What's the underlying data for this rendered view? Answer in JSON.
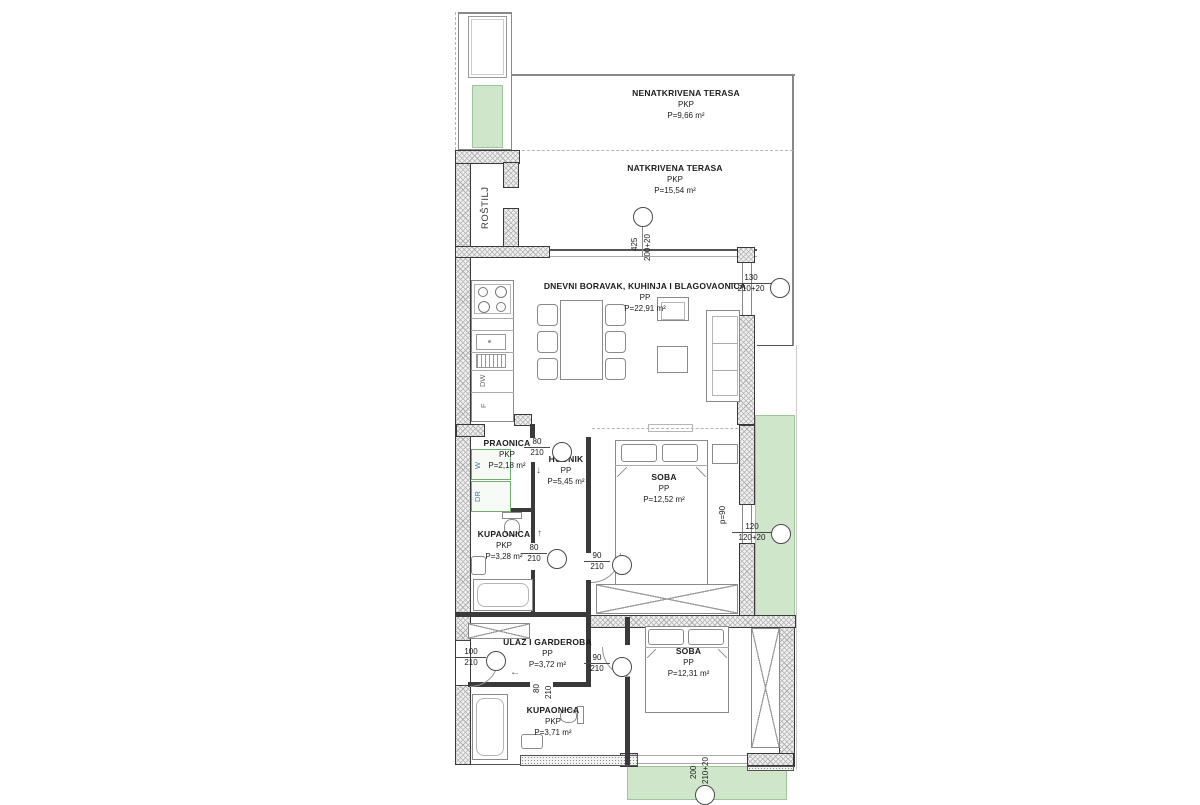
{
  "rooms": {
    "nenatkrivena_terasa": {
      "name": "NENATKRIVENA TERASA",
      "type": "PKP",
      "area": "P=9,66 m²"
    },
    "natkrivena_terasa": {
      "name": "NATKRIVENA TERASA",
      "type": "PKP",
      "area": "P=15,54 m²"
    },
    "dnevni_boravak": {
      "name": "DNEVNI BORAVAK, KUHINJA I BLAGOVAONICA",
      "type": "PP",
      "area": "P=22,91 m²"
    },
    "rostilj": {
      "name": "ROŠTILJ"
    },
    "praonica": {
      "name": "PRAONICA",
      "type": "PKP",
      "area": "P=2,18 m²"
    },
    "hodnik": {
      "name": "HODNIK",
      "type": "PP",
      "area": "P=5,45 m²"
    },
    "soba_1": {
      "name": "SOBA",
      "type": "PP",
      "area": "P=12,52 m²"
    },
    "kupaonica_1": {
      "name": "KUPAONICA",
      "type": "PKP",
      "area": "P=3,28 m²"
    },
    "ulaz_i_garderoba": {
      "name": "ULAZ I GARDEROBA",
      "type": "PP",
      "area": "P=3,72 m²"
    },
    "kupaonica_2": {
      "name": "KUPAONICA",
      "type": "PKP",
      "area": "P=3,71 m²"
    },
    "soba_2": {
      "name": "SOBA",
      "type": "PP",
      "area": "P=12,31 m²"
    }
  },
  "appliances": {
    "washer": "W",
    "dryer": "DR",
    "dishwasher": "DW",
    "fridge": "F"
  },
  "openings": {
    "terasa_vrata": {
      "width": "425",
      "height": "200+20"
    },
    "dnevni_vrata": {
      "width": "130",
      "height": "210+20"
    },
    "praonica_vrata": {
      "width": "80",
      "height": "210"
    },
    "kupaonica1_vrata": {
      "width": "80",
      "height": "210"
    },
    "soba1_vrata": {
      "width": "90",
      "height": "210"
    },
    "soba1_prozor": {
      "width": "120",
      "height": "120+20"
    },
    "ulaz_vrata": {
      "width": "100",
      "height": "210"
    },
    "soba2_vrata": {
      "width": "90",
      "height": "210"
    },
    "kupaonica2_vrata": {
      "width": "80",
      "height": "210"
    },
    "soba2_prozor": {
      "width": "200",
      "height": "210+20"
    },
    "parapet": "p=90"
  },
  "symbols": {
    "arrow_down": "↓",
    "arrow_up": "↑",
    "arrow_left": "←"
  },
  "colors": {
    "terrace_green": "#cfe6cb",
    "green_border": "#9dc69a",
    "wall_line": "#3a3a3a",
    "appliance_label_blue": "#4a6fb5"
  }
}
